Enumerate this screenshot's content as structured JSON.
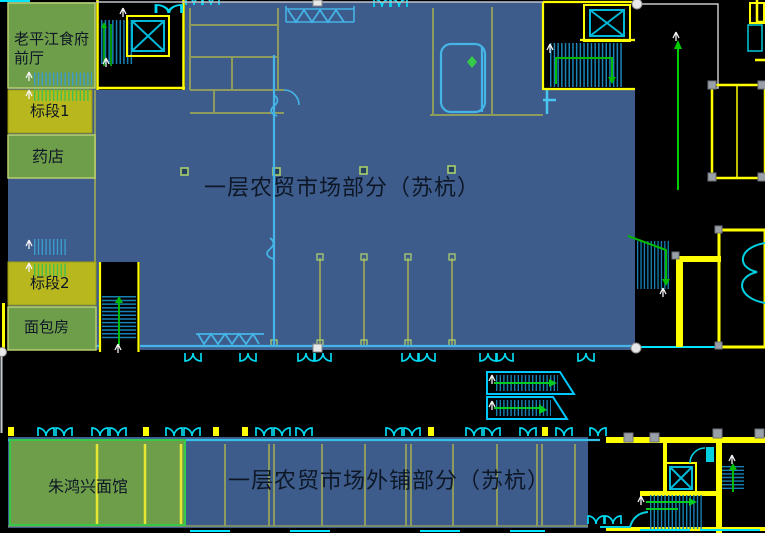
{
  "drawing": {
    "type": "cad-floor-plan",
    "regions": {
      "front_hall": {
        "label": "老平江食府\n前厅"
      },
      "section1": {
        "label": "标段1"
      },
      "pharmacy": {
        "label": "药店"
      },
      "section2": {
        "label": "标段2"
      },
      "bakery": {
        "label": "面包房"
      },
      "main_market": {
        "label": "一层农贸市场部分（苏杭）"
      },
      "outer_shops": {
        "label": "一层农贸市场外铺部分（苏杭）"
      },
      "noodle_shop": {
        "label": "朱鸿兴面馆"
      }
    },
    "colors": {
      "region_green": "#6f9e4a",
      "region_yellow": "#b8b81e",
      "region_blue": "#3d5c8c",
      "cad_yellow": "#ffff00",
      "cad_cyan": "#00e5ff",
      "cad_green": "#00cc22",
      "background": "#000000",
      "label_text": "#0d1726"
    }
  }
}
